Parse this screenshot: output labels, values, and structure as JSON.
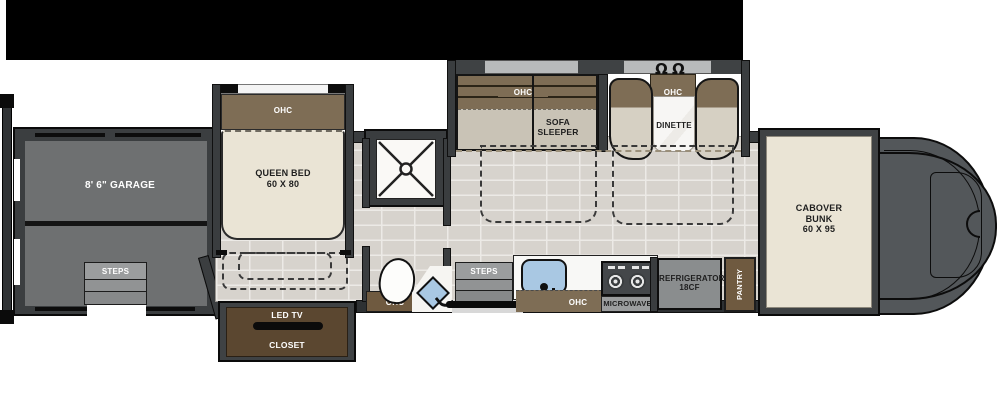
{
  "labels": {
    "garage": "8' 6\" GARAGE",
    "garage_steps": "STEPS",
    "bedroom_ohc": "OHC",
    "queen_bed_line1": "QUEEN BED",
    "queen_bed_line2": "60 X 80",
    "led_tv": "LED TV",
    "closet": "CLOSET",
    "sofa_ohc": "OHC",
    "sofa_line1": "SOFA",
    "sofa_line2": "SLEEPER",
    "dinette_ohc": "OHC",
    "dinette": "DINETTE",
    "bath_ohc": "OHC",
    "entry_steps": "STEPS",
    "kitchen_ohc": "OHC",
    "microwave": "MICROWAVE",
    "refrigerator_line1": "REFRIGERATOR",
    "refrigerator_line2": "18CF",
    "pantry": "PANTRY",
    "cabover_line1": "CABOVER",
    "cabover_line2": "BUNK",
    "cabover_line3": "60 X 95"
  },
  "icons": {
    "dinette_chair": "Ω"
  },
  "colors": {
    "awning_black": "#000000",
    "wall_dark": "#3a3d3f",
    "garage_gray": "#6e7071",
    "floor_tile": "#d7d3cd",
    "cabinet_brown": "#7e6d55",
    "closet_brown": "#5b4730",
    "bed_cream": "#eae4d5",
    "steps_gray": "#9b9d9e",
    "sink_blue": "#a9c8e3",
    "cab_gray": "#53575a"
  }
}
